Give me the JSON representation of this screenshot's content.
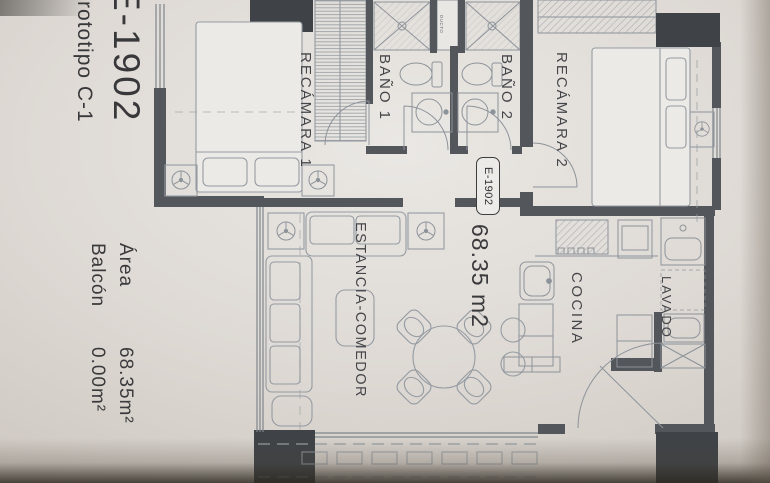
{
  "plan": {
    "title": "E-1902",
    "subtitle": "Prototipo C-1",
    "area_table": {
      "rows": [
        {
          "label": "Área",
          "value": "68.35m²"
        },
        {
          "label": "Balcón",
          "value": "0.00m²"
        }
      ]
    },
    "unit_tag": "E-1902",
    "unit_area": "68.35 m2",
    "rooms": {
      "bedroom1": "RECÁMARA 1",
      "bath1": "BAÑO 1",
      "bath2": "BAÑO 2",
      "bedroom2": "RECÁMARA 2",
      "living": "ESTANCIA-COMEDOR",
      "kitchen": "COCINA",
      "laundry": "LAVADO",
      "duct": "DUCTO"
    },
    "colors": {
      "paper": "#e8e6e2",
      "wall": "#53565a",
      "column": "#3f4347",
      "line": "#8d939a",
      "text": "#3f4042"
    }
  }
}
